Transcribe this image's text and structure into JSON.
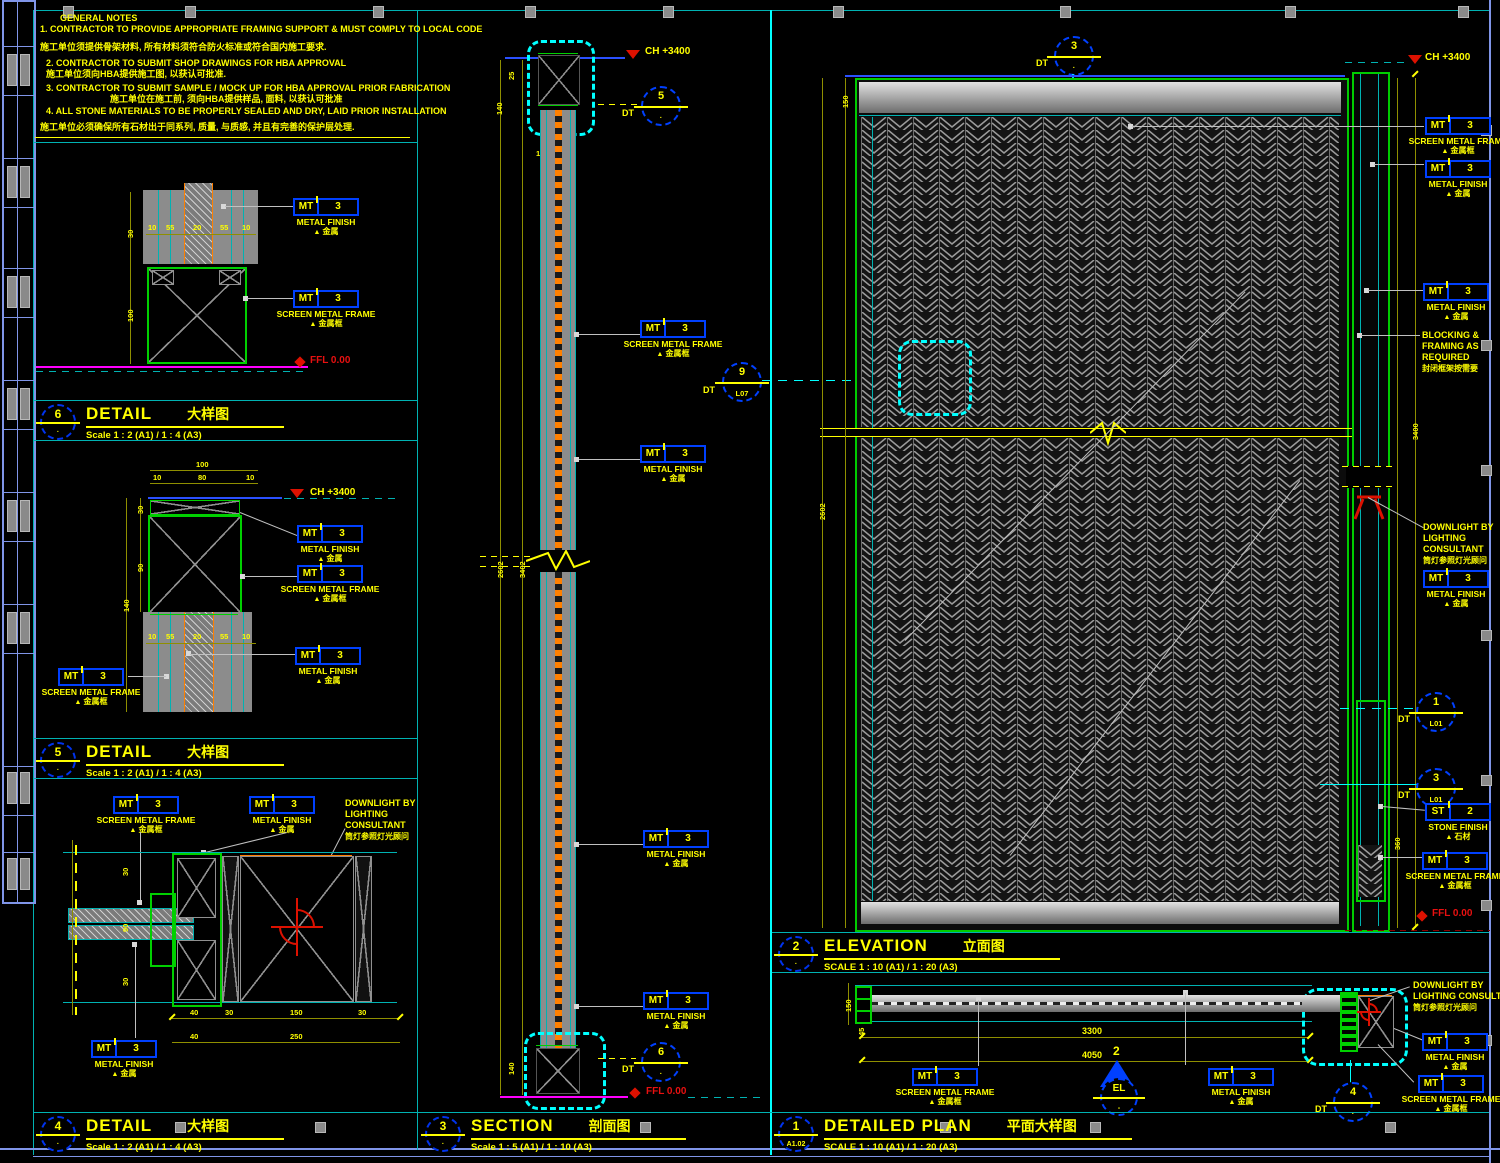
{
  "colors": {
    "yellow": "#ffff00",
    "tag_blue": "#0040ff",
    "cyan": "#00ffff",
    "teal": "#00b2b2",
    "green": "#00d000",
    "magenta": "#ff00ff",
    "red": "#dd1100",
    "orange": "#ff8000",
    "sheet_blue": "#8095e8",
    "hatch_gray": "#9b9b9b"
  },
  "notes": {
    "header": "GENERAL NOTES",
    "lines": [
      "1.  CONTRACTOR TO PROVIDE APPROPRIATE FRAMING SUPPORT & MUST COMPLY TO LOCAL CODE",
      "施工单位须提供骨架材料, 所有材料须符合防火标准或符合国内施工要求.",
      "2.  CONTRACTOR TO SUBMIT SHOP DRAWINGS FOR HBA APPROVAL",
      "施工单位须向HBA提供施工图, 以获认可批准.",
      "3.  CONTRACTOR TO SUBMIT SAMPLE / MOCK UP FOR HBA APPROVAL PRIOR FABRICATION",
      "施工单位在施工前, 须向HBA提供样品, 面料, 以获认可批准",
      "4.  ALL STONE MATERIALS TO BE PROPERLY SEALED AND DRY, LAID PRIOR INSTALLATION",
      "施工单位必须确保所有石材出于同系列, 质量, 与质感, 并且有完善的保护层处理."
    ]
  },
  "tag": {
    "mt": "MT",
    "st": "ST",
    "v3": "3",
    "v2": "2",
    "metal_finish": "METAL FINISH",
    "metal_finish_cn": "金属",
    "screen_frame": "SCREEN METAL FRAME",
    "screen_frame_cn": "金属框",
    "stone_finish": "STONE FINISH",
    "stone_finish_cn": "石材"
  },
  "markers": {
    "ch": "CH +3400",
    "ffl": "FFL 0.00",
    "dt": "DT"
  },
  "texts": {
    "downlight_l1": "DOWNLIGHT BY",
    "downlight_l2": "LIGHTING",
    "downlight_l3": "CONSULTANT",
    "downlight_l23": "LIGHTING CONSULTANT",
    "downlight_cn": "筒灯参照灯光顾问",
    "blocking_l1": "BLOCKING &",
    "blocking_l2": "FRAMING AS",
    "blocking_l3": "REQUIRED",
    "blocking_cn": "封闭框架按需要"
  },
  "callouts": {
    "sec_top": {
      "n": "5",
      "r": "·"
    },
    "sec_bot": {
      "n": "6",
      "r": "·"
    },
    "sec_mid": {
      "n": "9",
      "r": "L07"
    },
    "elev_cut": {
      "n": "3",
      "r": "·"
    },
    "plan_dl": {
      "n": "4",
      "r": "·"
    },
    "elev_r1": {
      "n": "1",
      "r": "L01"
    },
    "elev_r2": {
      "n": "3",
      "r": "L01"
    },
    "elev_ref": {
      "n": "2",
      "r": "EL"
    }
  },
  "titles": {
    "detail_floor": {
      "num": "6",
      "ref": "·",
      "name": "DETAIL",
      "cn": "大样图",
      "scale": "Scale 1 : 2 (A1) / 1 : 4 (A3)"
    },
    "detail_ceiling": {
      "num": "5",
      "ref": "·",
      "name": "DETAIL",
      "cn": "大样图",
      "scale": "Scale 1 : 2 (A1) / 1 : 4 (A3)"
    },
    "detail_plan": {
      "num": "4",
      "ref": "·",
      "name": "DETAIL",
      "cn": "大样图",
      "scale": "Scale 1 : 2 (A1) / 1 : 4 (A3)"
    },
    "section": {
      "num": "3",
      "ref": "·",
      "name": "SECTION",
      "cn": "剖面图",
      "scale": "Scale 1 : 5 (A1) / 1 : 10 (A3)"
    },
    "elevation": {
      "num": "2",
      "ref": "·",
      "name": "ELEVATION",
      "cn": "立面图",
      "scale": "SCALE 1 : 10 (A1) / 1 : 20 (A3)"
    },
    "plan": {
      "num": "1",
      "ref": "A1.02",
      "name": "DETAILED PLAN",
      "cn": "平面大样图",
      "scale": "SCALE 1 : 10 (A1) / 1 : 20 (A3)"
    }
  },
  "dims": {
    "floor_left": [
      "30",
      "100"
    ],
    "floor_row": [
      "10",
      "55",
      "20",
      "55",
      "10"
    ],
    "ceil_top": [
      "100",
      "80",
      "10",
      "10"
    ],
    "ceil_left": [
      "30",
      "90",
      "140"
    ],
    "ceil_row": [
      "10",
      "55",
      "20",
      "55",
      "10"
    ],
    "plan3_cols": [
      "30",
      "90",
      "30"
    ],
    "plan3_row1": [
      "40",
      "30",
      "150",
      "30"
    ],
    "plan3_row2": [
      "40",
      "250"
    ],
    "sec_left": [
      "25",
      "140"
    ],
    "sec_row": [
      "15",
      "35",
      "15"
    ],
    "sec_mid": [
      "2602",
      "3402"
    ],
    "sec_bot": "140",
    "elev_left": [
      "150",
      "2602"
    ],
    "elev_right": [
      "3400",
      "360"
    ],
    "plan_w": [
      "3300",
      "4050"
    ],
    "plan_left": [
      "150",
      "45"
    ]
  }
}
